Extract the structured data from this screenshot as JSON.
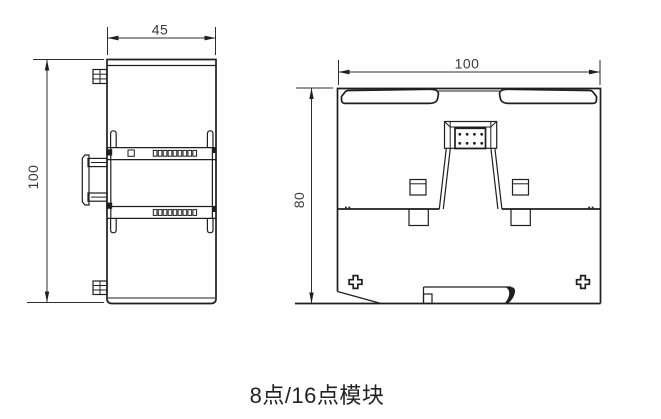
{
  "caption": {
    "text": "8点/16点模块"
  },
  "side_view": {
    "width_dim_label": "45",
    "height_dim_label": "100"
  },
  "front_view": {
    "width_dim_label": "100",
    "height_dim_label": "80"
  },
  "colors": {
    "background": "#ffffff",
    "line": "#1f1f1f",
    "dimension_text": "#3a3a3a",
    "caption_text": "#212121"
  }
}
